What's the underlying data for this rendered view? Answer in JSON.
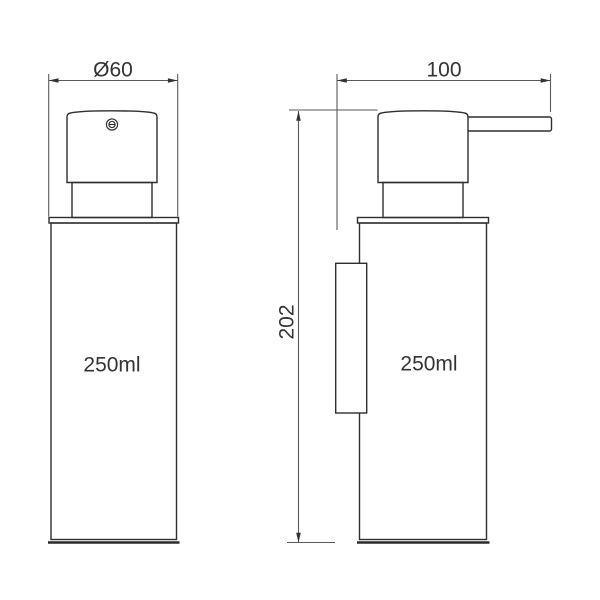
{
  "drawing": {
    "background_color": "#ffffff",
    "outline_color": "#2e2e2e",
    "dimension_line_color": "#5a5a5a",
    "text_color": "#333333"
  },
  "front_view": {
    "diameter_dimension": "Ø60",
    "volume_label": "250ml"
  },
  "side_view": {
    "depth_dimension": "100",
    "height_dimension": "202",
    "volume_label": "250ml"
  }
}
